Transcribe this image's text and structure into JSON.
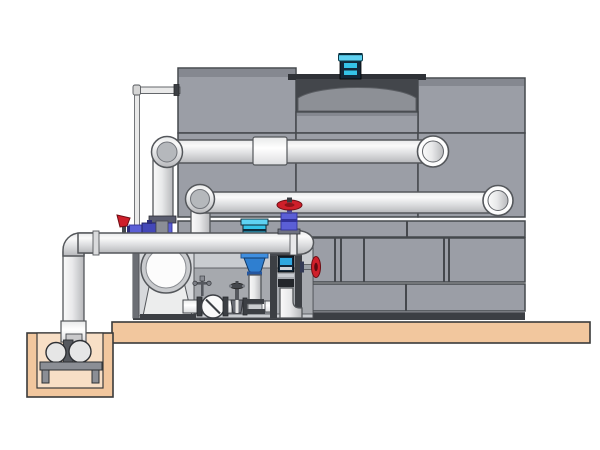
{
  "alt": "Technical illustration of a cooling tower cell with fan motor, external piping, pump skid with valves and a remote sump pump in a pit",
  "components": [
    "cooling-tower-casing",
    "fan-discharge-cowl",
    "fan-motor",
    "upper-return-pipe",
    "lower-return-pipe",
    "outlet-manifold-pipe",
    "pipe-end-cap",
    "pipe-coupling-sleeve",
    "makeup-water-line",
    "vertical-inline-pump",
    "inline-pump-motor",
    "suction-volute",
    "check-valve",
    "gate-valve",
    "vent-cock",
    "globe-valve-red-handwheel",
    "side-valve-red-handwheel",
    "drain-lever-valve",
    "ball-valves",
    "control-box",
    "valve-stand-frame",
    "concrete-slab",
    "sump-pit",
    "sump-pump",
    "pump-stand"
  ],
  "colors": {
    "background": "#ffffff",
    "panel": "#9b9ea6",
    "panel_top": "#858890",
    "panel_edge": "#45484d",
    "cavity": "#43464b",
    "cavity_rim": "#2f3237",
    "shroud": "#8d9096",
    "pipe_light": "#fafafa",
    "pipe_mid": "#e8e9ea",
    "pipe_mid2": "#dcdddf",
    "pipe_dark": "#b7b8bb",
    "pipe_edge": "#54575b",
    "sleeve_light": "#ffffff",
    "slab": "#f2c79e",
    "pit_inner": "#f8dfc6",
    "ground_edge": "#3a3a3a",
    "motor_cyan": "#35c3e8",
    "motor_cyan_light": "#5fd2f2",
    "motor_dark": "#14283a",
    "valve_red": "#cf1f2a",
    "valve_red_dark": "#6e0d14",
    "valve_blue": "#5b5fd6",
    "valve_blue_dark": "#32329a",
    "frame_dark": "#3c3f44",
    "frame_mid": "#55585e",
    "skid_back": "#c9ccd0",
    "skid_mid": "#a6a9ae",
    "steel_blue": "#2f7fd0",
    "steel_blue_dark": "#1d4f8c",
    "screen_cyan": "#2fa8e0",
    "metal": "#8b8e95",
    "white": "#fdfdfd"
  }
}
